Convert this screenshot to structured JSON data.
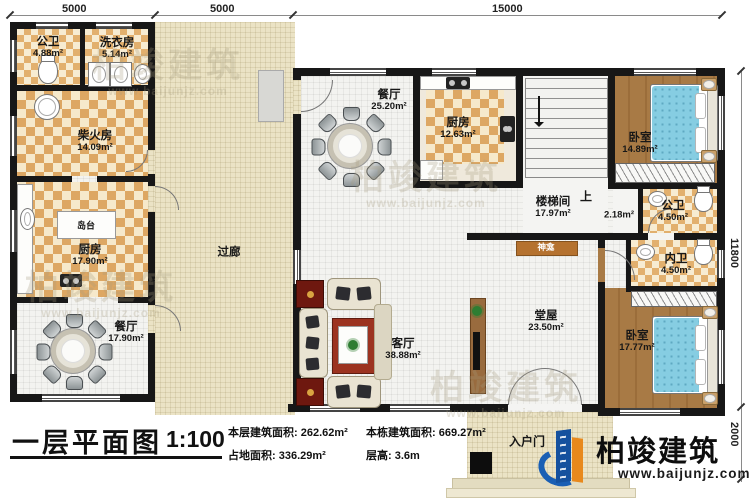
{
  "plan": {
    "title": "一层平面图",
    "scale": "1:100",
    "stats": [
      {
        "label": "本层建筑面积:",
        "value": "262.62m²"
      },
      {
        "label": "占地面积:",
        "value": "336.29m²"
      },
      {
        "label": "本栋建筑面积:",
        "value": "669.27m²"
      },
      {
        "label": "层高:",
        "value": "3.6m"
      }
    ]
  },
  "logo": {
    "name": "柏竣建筑",
    "site": "www.baijunjz.com"
  },
  "watermark": {
    "text": "柏竣建筑",
    "site": "www.baijunjz.com"
  },
  "dims": {
    "top": [
      "5000",
      "5000",
      "15000"
    ],
    "right": [
      "11800",
      "2000"
    ]
  },
  "rooms": [
    {
      "name": "公卫",
      "area": "4.88m²"
    },
    {
      "name": "洗衣房",
      "area": "5.14m²"
    },
    {
      "name": "柴火房",
      "area": "14.09m²"
    },
    {
      "name": "厨房",
      "area": "17.90m²"
    },
    {
      "name": "餐厅",
      "area": "17.90m²"
    },
    {
      "name": "过廊",
      "area": ""
    },
    {
      "name": "餐厅",
      "area": "25.20m²"
    },
    {
      "name": "厨房",
      "area": "12.63m²"
    },
    {
      "name": "楼梯间",
      "area": "17.97m²"
    },
    {
      "name": "卧室",
      "area": "14.89m²"
    },
    {
      "name": "公卫",
      "area": "4.50m²"
    },
    {
      "name": "内卫",
      "area": "4.50m²"
    },
    {
      "name": "卧室",
      "area": "17.77m²"
    },
    {
      "name": "客厅",
      "area": "38.88m²"
    },
    {
      "name": "堂屋",
      "area": "23.50m²"
    },
    {
      "name": "",
      "area": "2.18m²"
    }
  ],
  "misc": {
    "island": "岛台",
    "shrine": "神龛",
    "up": "上",
    "entry": "入户门"
  },
  "colors": {
    "wall": "#171717",
    "tile": "#dda763",
    "wood": "#a87a45",
    "bed": "#86cde2",
    "logo_blue": "#1a5fb4"
  }
}
